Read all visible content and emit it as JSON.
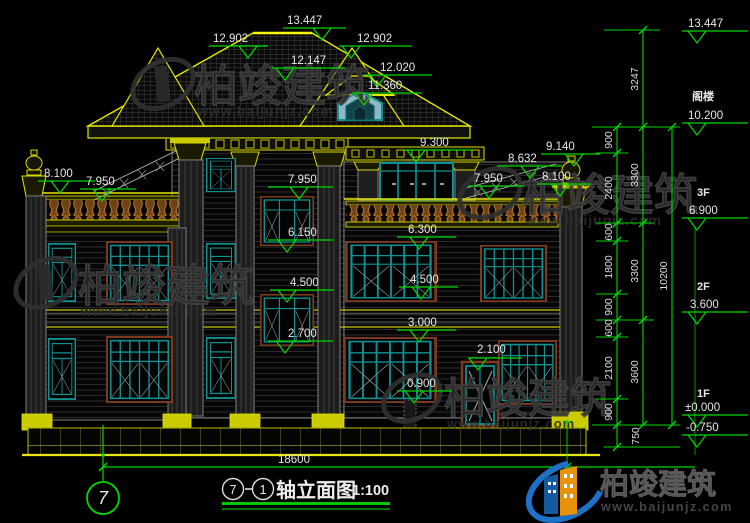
{
  "watermark": {
    "company": "柏竣建筑",
    "website": "www.baijunjz.com"
  },
  "logo": {
    "company": "柏竣建筑",
    "website": "www.baijunjz.com"
  },
  "axis_bubble": {
    "number": "7"
  },
  "title_bar": {
    "bubble_start": "7",
    "separator": "—",
    "bubble_end": "1",
    "text": "轴立面图",
    "scale": "1:100"
  },
  "bottom_dim": {
    "total_width": "18600"
  },
  "elev_marks": [
    "13.447",
    "12.902",
    "12.902",
    "12.147",
    "12.020",
    "11.360",
    "9.300",
    "9.140",
    "8.632",
    "8.100",
    "7.950",
    "8.100",
    "7.950",
    "7.950",
    "6.150",
    "4.500",
    "2.700",
    "6.300",
    "4.500",
    "3.000",
    "2.100",
    "0.900"
  ],
  "right_panel": {
    "levels": [
      {
        "floor": "",
        "value": "13.447"
      },
      {
        "floor": "阁楼",
        "value": "10.200"
      },
      {
        "floor": "3F",
        "value": "6.900"
      },
      {
        "floor": "2F",
        "value": "3.600"
      },
      {
        "floor": "1F",
        "value": "±0.000"
      },
      {
        "floor": "",
        "value": "-0.750"
      }
    ],
    "chain_inner": [
      "900",
      "2400",
      "600",
      "1800",
      "900",
      "600",
      "2100",
      "900",
      "750"
    ],
    "chain_mid": [
      "3247",
      "3300",
      "3300",
      "3600"
    ],
    "chain_outer": [
      "10200"
    ]
  }
}
